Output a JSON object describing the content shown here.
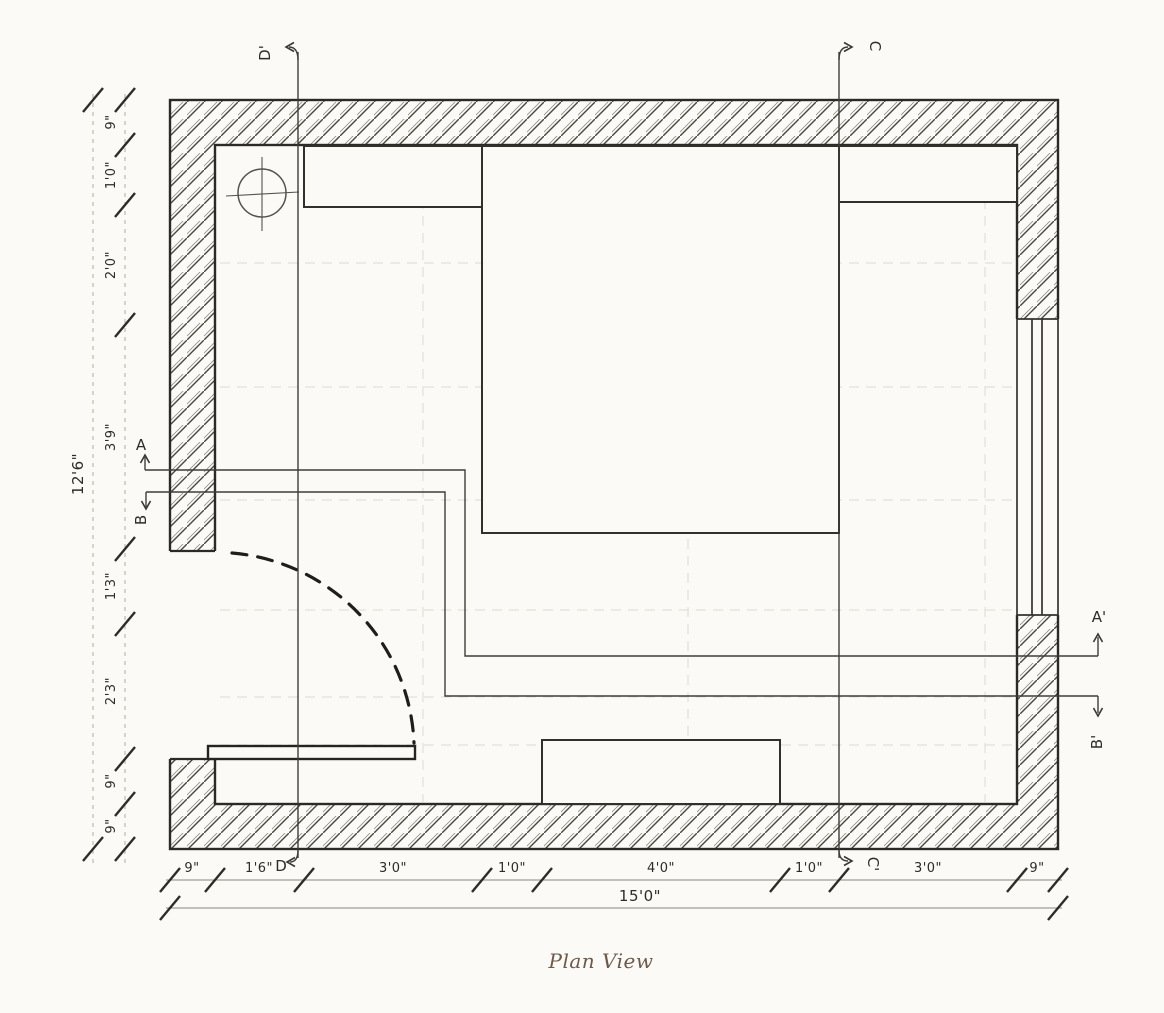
{
  "caption": "Plan View",
  "dimensions": {
    "left": {
      "overall": "12'6\"",
      "segments": [
        "9\"",
        "1'0\"",
        "2'0\"",
        "3'9\"",
        "1'3\"",
        "2'3\"",
        "9\"",
        "9\""
      ]
    },
    "bottom": {
      "overall": "15'0\"",
      "segments": [
        "9\"",
        "1'6\"",
        "3'0\"",
        "1'0\"",
        "4'0\"",
        "1'0\"",
        "3'0\"",
        "9\""
      ]
    }
  },
  "section_markers": {
    "a": "A",
    "a_prime": "A'",
    "b": "B",
    "b_prime": "B'",
    "c": "C",
    "c_prime": "C'",
    "d": "D",
    "d_prime": "D'"
  }
}
